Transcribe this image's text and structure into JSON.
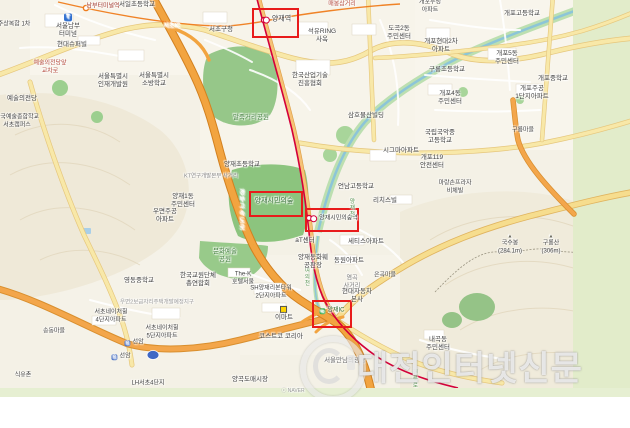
{
  "watermark": {
    "text": "대전인터넷신문"
  },
  "map": {
    "colors": {
      "highlight_red": "#e81b1b",
      "expressway_orange": "#f2a440",
      "shinbundang_line_red": "#d4003a",
      "line3_orange": "#ef7c1c",
      "park_green": "#8cc47e",
      "greenbelt_band": "#e2ecca"
    },
    "highlights": [
      {
        "x": 252,
        "y": 8,
        "w": 43,
        "h": 26
      },
      {
        "x": 249,
        "y": 191,
        "w": 50,
        "h": 22
      },
      {
        "x": 305,
        "y": 208,
        "w": 50,
        "h": 20
      },
      {
        "x": 312,
        "y": 300,
        "w": 36,
        "h": 24
      }
    ],
    "labels": [
      {
        "lines": [
          "남부터미널역"
        ],
        "x": 103,
        "y": 7,
        "c": "#9d2f22",
        "s": 6
      },
      {
        "lines": [
          "양재역"
        ],
        "x": 277,
        "y": 20,
        "ic": "station",
        "s": 7
      },
      {
        "lines": [
          "양재시민의숲"
        ],
        "x": 274,
        "y": 202,
        "c": "#2e6b2e",
        "s": 7
      },
      {
        "lines": [
          "양재시민의숲역"
        ],
        "x": 334,
        "y": 219,
        "ic": "station",
        "s": 6
      },
      {
        "lines": [
          "양재IC"
        ],
        "x": 332,
        "y": 311,
        "ic": "ic",
        "c": "#2e6b2e",
        "s": 6
      },
      {
        "lines": [
          "서초IC"
        ],
        "x": 172,
        "y": 27,
        "c": "#ffffff",
        "s": 6
      },
      {
        "lines": [
          "경부고속도로"
        ],
        "x": 240,
        "y": 210,
        "c": "#ffffff",
        "v": 1,
        "s": 6
      },
      {
        "lines": [
          "매봉삼거리"
        ],
        "x": 342,
        "y": 5,
        "c": "#b3473a",
        "s": 6
      },
      {
        "lines": [
          "예술의전당앞",
          "교차로"
        ],
        "x": 50,
        "y": 68,
        "c": "#b3473a",
        "s": 6
      },
      {
        "lines": [
          "염곡",
          "사거리"
        ],
        "x": 352,
        "y": 283,
        "c": "#777777",
        "s": 6
      },
      {
        "lines": [
          "KT연구개발본부 사거리"
        ],
        "x": 211,
        "y": 177,
        "c": "#888888",
        "s": 5.5
      },
      {
        "lines": [
          "우면2보금자리주택개발예정지구"
        ],
        "x": 157,
        "y": 303,
        "c": "#999999",
        "s": 5.5
      },
      {
        "lines": [
          "여의천"
        ],
        "x": 306,
        "y": 277,
        "c": "#4f8f4a",
        "v": 1,
        "s": 5.5
      },
      {
        "lines": [
          "양재천"
        ],
        "x": 351,
        "y": 208,
        "c": "#4f8f4a",
        "v": 1,
        "s": 5.5
      },
      {
        "lines": [
          "헌릉로"
        ],
        "x": 414,
        "y": 379,
        "c": "#4f8f4a",
        "v": 1,
        "s": 5.5
      },
      {
        "lines": [
          "서일초등학교"
        ],
        "x": 137,
        "y": 5
      },
      {
        "lines": [
          "서울남부",
          "터미널"
        ],
        "x": 68,
        "y": 26,
        "ic": "terminal"
      },
      {
        "lines": [
          "현대슈퍼빌"
        ],
        "x": 72,
        "y": 45
      },
      {
        "lines": [
          "주상복합 1차"
        ],
        "x": 14,
        "y": 25,
        "s": 6
      },
      {
        "lines": [
          "예술의전당"
        ],
        "x": 22,
        "y": 99
      },
      {
        "lines": [
          "한국예술종합학교",
          "서초캠퍼스"
        ],
        "x": 17,
        "y": 122,
        "s": 6
      },
      {
        "lines": [
          "서울특별시",
          "인재개발원"
        ],
        "x": 113,
        "y": 81
      },
      {
        "lines": [
          "서울특별시",
          "소방학교"
        ],
        "x": 154,
        "y": 80
      },
      {
        "lines": [
          "서초구청"
        ],
        "x": 221,
        "y": 30
      },
      {
        "lines": [
          "석유RING",
          "사옥"
        ],
        "x": 322,
        "y": 36
      },
      {
        "lines": [
          "도곡2동",
          "주민센터"
        ],
        "x": 399,
        "y": 33
      },
      {
        "lines": [
          "한국산업기술",
          "진흥협회"
        ],
        "x": 310,
        "y": 80
      },
      {
        "lines": [
          "삼호물산빌딩"
        ],
        "x": 366,
        "y": 116
      },
      {
        "lines": [
          "말죽거리공원"
        ],
        "x": 251,
        "y": 118,
        "c": "#3f7d39"
      },
      {
        "lines": [
          "양재초등학교"
        ],
        "x": 242,
        "y": 165
      },
      {
        "lines": [
          "시그마아파트"
        ],
        "x": 401,
        "y": 151
      },
      {
        "lines": [
          "언남고등학교"
        ],
        "x": 356,
        "y": 187
      },
      {
        "lines": [
          "리치스빌"
        ],
        "x": 385,
        "y": 201
      },
      {
        "lines": [
          "양재1동",
          "주민센터"
        ],
        "x": 183,
        "y": 201
      },
      {
        "lines": [
          "우면주공",
          "아파트"
        ],
        "x": 165,
        "y": 216
      },
      {
        "lines": [
          "영동중학교"
        ],
        "x": 139,
        "y": 281
      },
      {
        "lines": [
          "한국교원단체",
          "총연합회"
        ],
        "x": 198,
        "y": 280
      },
      {
        "lines": [
          "문화예술",
          "공원"
        ],
        "x": 225,
        "y": 256,
        "c": "#3f7d39"
      },
      {
        "lines": [
          "The-K",
          "호텔서울"
        ],
        "x": 243,
        "y": 279,
        "s": 6
      },
      {
        "lines": [
          "aT센터"
        ],
        "x": 305,
        "y": 241
      },
      {
        "lines": [
          "양재동화훼",
          "공판장"
        ],
        "x": 313,
        "y": 262
      },
      {
        "lines": [
          "세티스아파트"
        ],
        "x": 366,
        "y": 242
      },
      {
        "lines": [
          "동원아파트"
        ],
        "x": 349,
        "y": 261
      },
      {
        "lines": [
          "현대자동차",
          "본사"
        ],
        "x": 357,
        "y": 296
      },
      {
        "lines": [
          "은곡마을"
        ],
        "x": 385,
        "y": 276,
        "s": 6
      },
      {
        "lines": [
          "SH양재리본타워",
          "2단지아파트"
        ],
        "x": 271,
        "y": 293,
        "s": 6
      },
      {
        "lines": [
          "이마트"
        ],
        "x": 284,
        "y": 314,
        "ic": "mart"
      },
      {
        "lines": [
          "코스트코 코리아"
        ],
        "x": 281,
        "y": 337
      },
      {
        "lines": [
          "양곡도매시장"
        ],
        "x": 250,
        "y": 380
      },
      {
        "lines": [
          "서울만남의광장"
        ],
        "x": 345,
        "y": 361,
        "c": "#6c6c6c",
        "s": 6.5
      },
      {
        "lines": [
          "내곡동",
          "주민센터"
        ],
        "x": 438,
        "y": 344
      },
      {
        "lines": [
          "송동마을"
        ],
        "x": 54,
        "y": 332,
        "s": 6
      },
      {
        "lines": [
          "식유촌"
        ],
        "x": 23,
        "y": 376,
        "s": 6
      },
      {
        "lines": [
          "선암"
        ],
        "x": 134,
        "y": 343,
        "ic": "toll",
        "s": 6
      },
      {
        "lines": [
          "선암"
        ],
        "x": 121,
        "y": 357,
        "ic": "toll",
        "s": 6
      },
      {
        "lines": [
          "서초네이처힐",
          "4단지아파트"
        ],
        "x": 111,
        "y": 317,
        "s": 6
      },
      {
        "lines": [
          "서초네이처힐",
          "5단지아파트"
        ],
        "x": 162,
        "y": 333,
        "s": 6
      },
      {
        "lines": [
          "LH서초4단지"
        ],
        "x": 148,
        "y": 384,
        "s": 6
      },
      {
        "lines": [
          "개포우성",
          "아파트"
        ],
        "x": 430,
        "y": 7,
        "s": 6
      },
      {
        "lines": [
          "개포고등학교"
        ],
        "x": 522,
        "y": 14
      },
      {
        "lines": [
          "개포현대2차",
          "아파트"
        ],
        "x": 441,
        "y": 46
      },
      {
        "lines": [
          "구룡초등학교"
        ],
        "x": 447,
        "y": 70
      },
      {
        "lines": [
          "개포5동",
          "주민센터"
        ],
        "x": 507,
        "y": 58
      },
      {
        "lines": [
          "개포중학교"
        ],
        "x": 553,
        "y": 79
      },
      {
        "lines": [
          "개포주공",
          "1단지아파트"
        ],
        "x": 532,
        "y": 93
      },
      {
        "lines": [
          "개포4동",
          "주민센터"
        ],
        "x": 450,
        "y": 98
      },
      {
        "lines": [
          "국립국악중",
          "고등학교"
        ],
        "x": 440,
        "y": 137
      },
      {
        "lines": [
          "구룡마을"
        ],
        "x": 523,
        "y": 131,
        "s": 6
      },
      {
        "lines": [
          "개포119",
          "안전센터"
        ],
        "x": 432,
        "y": 162
      },
      {
        "lines": [
          "마랑손프라자",
          "비체빌"
        ],
        "x": 455,
        "y": 188,
        "s": 6
      },
      {
        "lines": [
          "국수봉",
          "(284.1m)"
        ],
        "x": 510,
        "y": 245,
        "ic": "peak",
        "s": 6
      },
      {
        "lines": [
          "구룡산",
          "(306m)"
        ],
        "x": 551,
        "y": 245,
        "ic": "peak",
        "s": 6
      },
      {
        "lines": [
          "ⓒ NAVER"
        ],
        "x": 293,
        "y": 391,
        "c": "#9a9a9a",
        "s": 5
      }
    ]
  }
}
